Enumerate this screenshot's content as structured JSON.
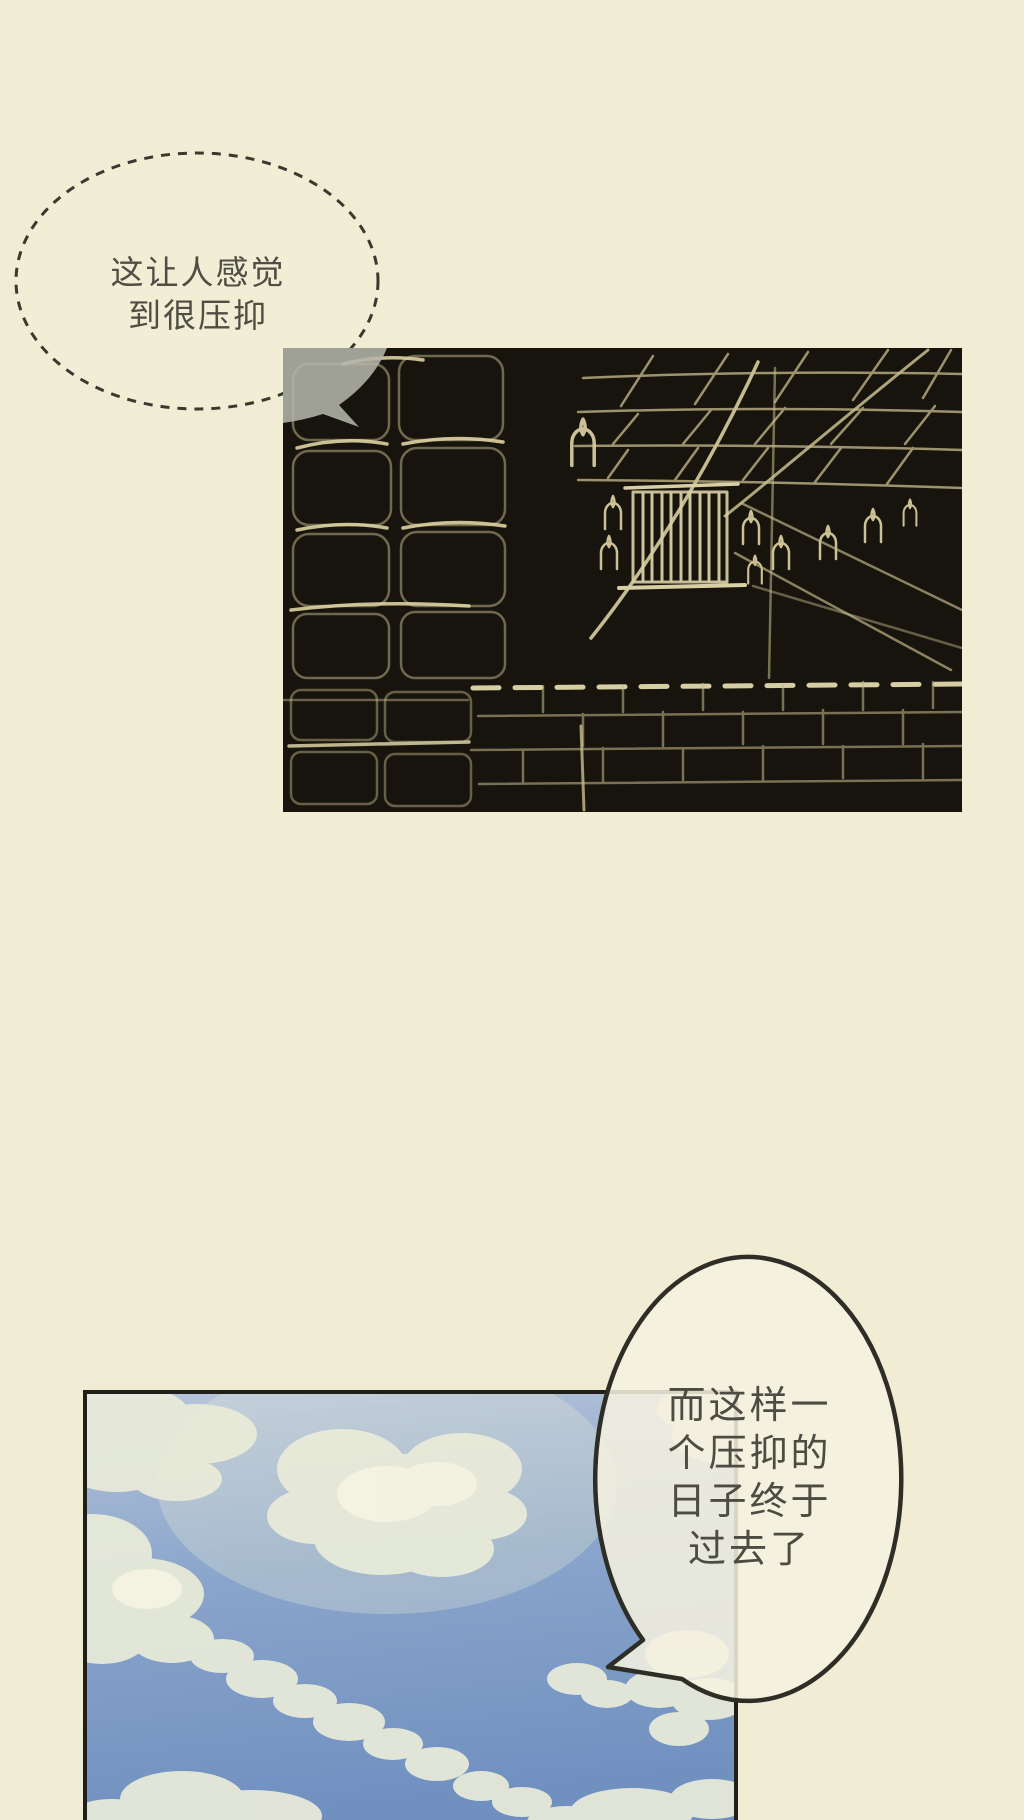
{
  "page": {
    "kind": "webtoon-comic-page",
    "background_color": "#f1edd5"
  },
  "speech_bubbles": {
    "top": {
      "style": "dashed-ellipse",
      "border_color": "#3a392f",
      "text_color": "#4f4e44",
      "lines": [
        "这让人感觉",
        "到很压抑"
      ]
    },
    "bottom": {
      "style": "solid-ellipse-with-tail",
      "border_color": "#2e2d26",
      "fill_color": "#f5f1e0",
      "text_color": "#4c4c42",
      "lines": [
        "而这样一",
        "个压抑的",
        "日子终于",
        "过去了"
      ]
    }
  },
  "panels": {
    "dungeon": {
      "description": "dark dungeon corridor drawn in light edge lines: stone block walls, ceiling rafters, central barred gate, candles",
      "background_color": "#16140d",
      "line_color": "#cfc394",
      "bubble_overlap_color": "#b3b4aa"
    },
    "sky": {
      "description": "blue sky with soft cream clouds",
      "border_color": "#201f19",
      "sky_top_color": "#b7c5da",
      "sky_bottom_color": "#7090c0",
      "cloud_color": "#eaecd9"
    }
  }
}
